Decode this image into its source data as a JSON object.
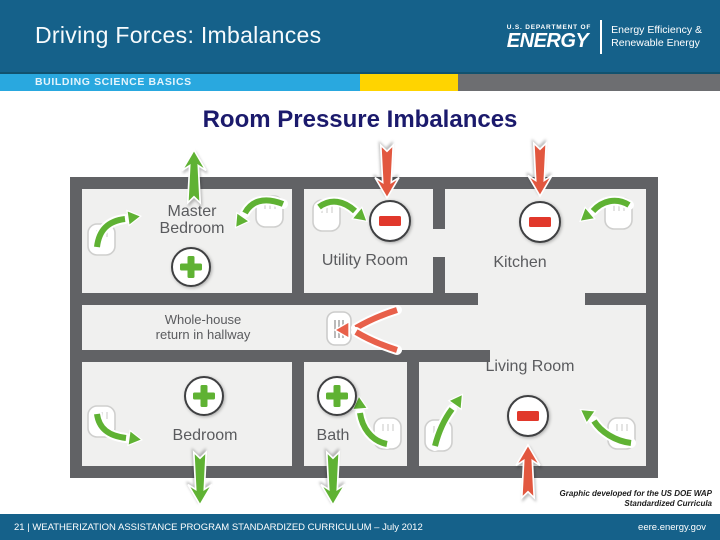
{
  "header": {
    "title": "Driving Forces: Imbalances",
    "logo": {
      "dept": "U.S. DEPARTMENT OF",
      "energy": "ENERGY",
      "eere1": "Energy Efficiency &",
      "eere2": "Renewable Energy"
    }
  },
  "banner": {
    "label": "BUILDING SCIENCE BASICS"
  },
  "diagram": {
    "title": "Room Pressure Imbalances",
    "rooms": [
      {
        "label": "Master Bedroom",
        "lines": [
          "Master",
          "Bedroom"
        ],
        "pressure": "+",
        "exterior_airflow": "out"
      },
      {
        "label": "Utility Room",
        "pressure": "-",
        "exterior_airflow": "in"
      },
      {
        "label": "Kitchen",
        "pressure": "-",
        "exterior_airflow": "in"
      },
      {
        "label": "Whole-house return in hallway",
        "lines": [
          "Whole-house",
          "return in hallway"
        ],
        "pressure": "",
        "exterior_airflow": "return-grille"
      },
      {
        "label": "Living Room",
        "pressure": "-",
        "exterior_airflow": "in"
      },
      {
        "label": "Bedroom",
        "pressure": "+",
        "exterior_airflow": "out"
      },
      {
        "label": "Bath",
        "pressure": "+",
        "exterior_airflow": "out"
      }
    ]
  },
  "caption": {
    "line1": "Graphic developed for the US DOE WAP",
    "line2": "Standardized Curricula"
  },
  "footer": {
    "left": "21 | WEATHERIZATION ASSISTANCE PROGRAM STANDARDIZED CURRICULUM – July 2012",
    "right": "eere.energy.gov"
  },
  "colors": {
    "header_teal": "#15618A",
    "banner_blue": "#29A8DF",
    "banner_yellow": "#FFD400",
    "banner_gray": "#6D6E71",
    "title_navy": "#1B1A6C",
    "wall_gray": "#616265",
    "room_fill": "#F0F0EF",
    "positive_green": "#5FB233",
    "negative_red": "#E2573F"
  }
}
